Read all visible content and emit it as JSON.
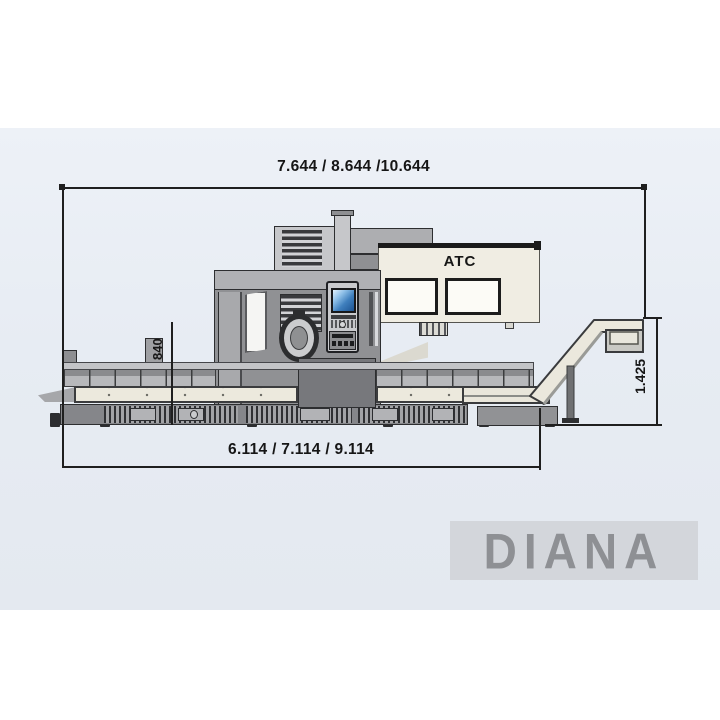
{
  "diagram": {
    "type": "machine-side-elevation",
    "dimensions": {
      "top_width_label": "7.644 / 8.644 /10.644",
      "bottom_width_label": "6.114 / 7.114 / 9.114",
      "left_height_label": "840",
      "right_height_label": "1.425"
    },
    "machine": {
      "atc_label": "ATC"
    },
    "brand": {
      "logo_text": "DIANA"
    },
    "colors": {
      "panel_background": "#e9edf4",
      "dimension_lines": "#1f1f1f",
      "machine_body_gray": "#909194",
      "machine_light_gray": "#c6c7ca",
      "cream_surfaces": "#ece9dd",
      "atc_cabinet": "#f0ede3",
      "control_screen_blue": "#2a6db0",
      "logo_gray": "#8e9094",
      "logo_background": "#d3d6db"
    }
  }
}
